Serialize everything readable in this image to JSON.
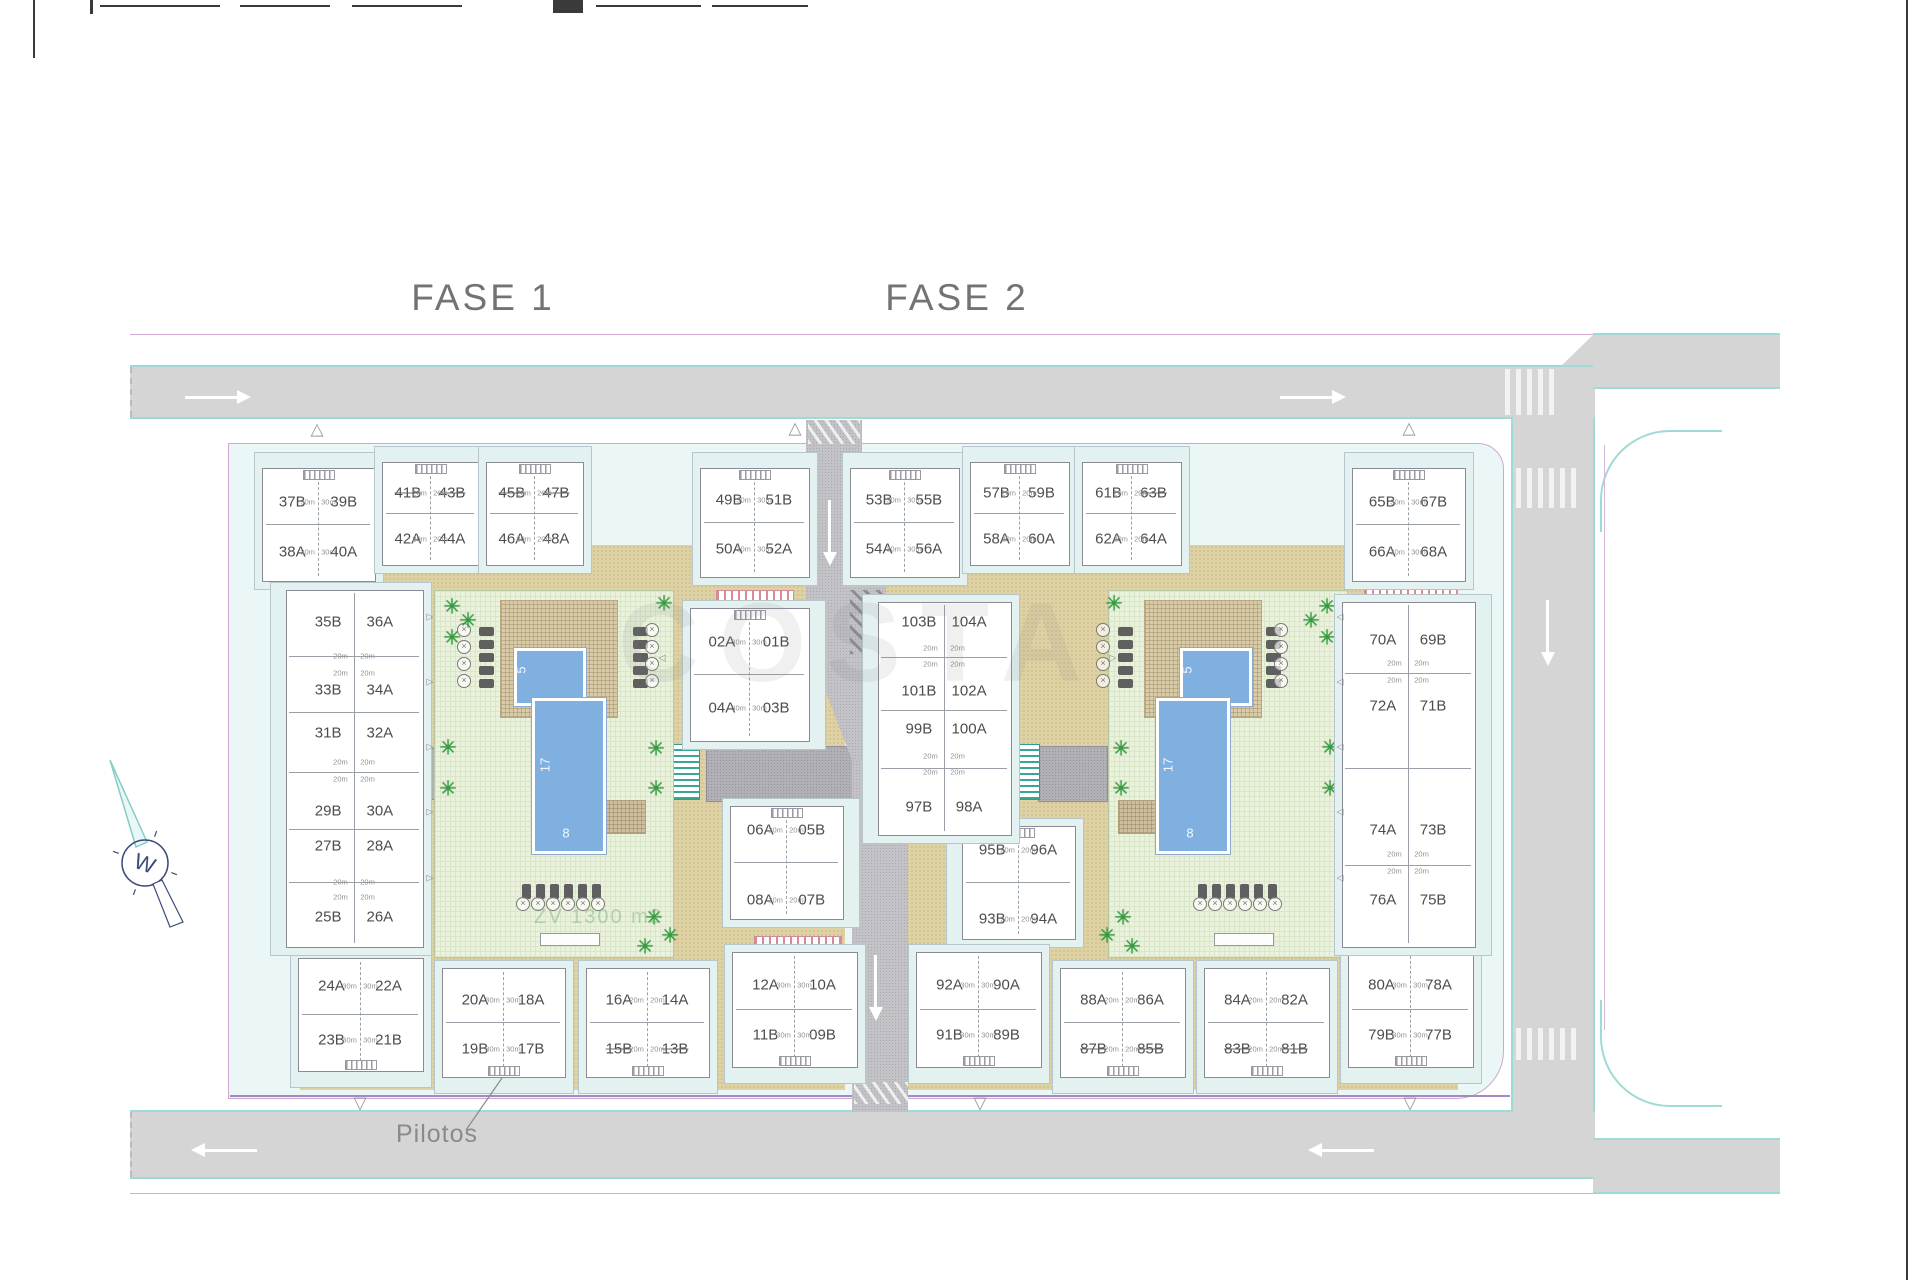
{
  "titles": [
    {
      "text": "FASE 1",
      "x": 483,
      "y": 277
    },
    {
      "text": "FASE 2",
      "x": 957,
      "y": 277
    }
  ],
  "watermark": "COSTA",
  "green_area_label": "ZV 1300 m2",
  "pilotos_label": "Pilotos",
  "compass_letter": "W",
  "pool_dims": {
    "length": "17",
    "width": "8",
    "kids": "5"
  },
  "strikes": [
    "41B",
    "43B",
    "45B",
    "47B",
    "15B",
    "13B",
    "63B",
    "87B",
    "85B",
    "83B",
    "81B"
  ],
  "plan": {
    "quads": [
      {
        "id": "q1",
        "x": 262,
        "y": 468,
        "w": 112,
        "h": 112,
        "tl": "37B",
        "tr": "39B",
        "bl": "38A",
        "br": "40A",
        "area": "30m",
        "pad": "top"
      },
      {
        "id": "q2",
        "x": 382,
        "y": 462,
        "w": 96,
        "h": 102,
        "tl": "41B",
        "tr": "43B",
        "bl": "42A",
        "br": "44A",
        "area": "20m",
        "pad": "top"
      },
      {
        "id": "q3",
        "x": 486,
        "y": 462,
        "w": 96,
        "h": 102,
        "tl": "45B",
        "tr": "47B",
        "bl": "46A",
        "br": "48A",
        "area": "20m",
        "pad": "top"
      },
      {
        "id": "q4",
        "x": 700,
        "y": 468,
        "w": 108,
        "h": 108,
        "tl": "49B",
        "tr": "51B",
        "bl": "50A",
        "br": "52A",
        "area": "30m",
        "pad": "top"
      },
      {
        "id": "q5",
        "x": 850,
        "y": 468,
        "w": 108,
        "h": 108,
        "tl": "53B",
        "tr": "55B",
        "bl": "54A",
        "br": "56A",
        "area": "30m",
        "pad": "top"
      },
      {
        "id": "q6",
        "x": 970,
        "y": 462,
        "w": 98,
        "h": 102,
        "tl": "57B",
        "tr": "59B",
        "bl": "58A",
        "br": "60A",
        "area": "20m",
        "pad": "top"
      },
      {
        "id": "q7",
        "x": 1082,
        "y": 462,
        "w": 98,
        "h": 102,
        "tl": "61B",
        "tr": "63B",
        "bl": "62A",
        "br": "64A",
        "area": "20m",
        "pad": "top"
      },
      {
        "id": "q8",
        "x": 1352,
        "y": 468,
        "w": 112,
        "h": 112,
        "tl": "65B",
        "tr": "67B",
        "bl": "66A",
        "br": "68A",
        "area": "30m",
        "pad": "top"
      },
      {
        "id": "q9",
        "x": 690,
        "y": 608,
        "w": 118,
        "h": 132,
        "tl": "02A",
        "tr": "01B",
        "bl": "04A",
        "br": "03B",
        "area": "30m",
        "pad": "right",
        "r1": 0.26,
        "r2": 0.76
      },
      {
        "id": "q10",
        "x": 730,
        "y": 806,
        "w": 112,
        "h": 112,
        "tl": "06A",
        "tr": "05B",
        "bl": "08A",
        "br": "07B",
        "area": "20m",
        "pad": "right",
        "r1": 0.21,
        "r2": 0.84
      },
      {
        "id": "q11",
        "x": 962,
        "y": 826,
        "w": 112,
        "h": 112,
        "tl": "95B",
        "tr": "96A",
        "bl": "93B",
        "br": "94A",
        "area": "20m",
        "pad": "left",
        "r1": 0.21,
        "r2": 0.83
      },
      {
        "id": "q12",
        "x": 298,
        "y": 958,
        "w": 124,
        "h": 112,
        "tl": "24A",
        "tr": "22A",
        "bl": "23B",
        "br": "21B",
        "area": "30m",
        "pad": "bottom",
        "r1": 0.25,
        "r2": 0.73
      },
      {
        "id": "q13",
        "x": 442,
        "y": 968,
        "w": 122,
        "h": 108,
        "tl": "20A",
        "tr": "18A",
        "bl": "19B",
        "br": "17B",
        "area": "30m",
        "pad": "bottom"
      },
      {
        "id": "q14",
        "x": 586,
        "y": 968,
        "w": 122,
        "h": 108,
        "tl": "16A",
        "tr": "14A",
        "bl": "15B",
        "br": "13B",
        "area": "20m",
        "pad": "bottom"
      },
      {
        "id": "q15",
        "x": 732,
        "y": 952,
        "w": 124,
        "h": 114,
        "tl": "12A",
        "tr": "10A",
        "bl": "11B",
        "br": "09B",
        "area": "30m",
        "pad": "bottom",
        "r1": 0.29,
        "r2": 0.73
      },
      {
        "id": "q16",
        "x": 916,
        "y": 952,
        "w": 124,
        "h": 114,
        "tl": "92A",
        "tr": "90A",
        "bl": "91B",
        "br": "89B",
        "area": "30m",
        "pad": "bottom",
        "r1": 0.29,
        "r2": 0.73
      },
      {
        "id": "q17",
        "x": 1060,
        "y": 968,
        "w": 124,
        "h": 108,
        "tl": "88A",
        "tr": "86A",
        "bl": "87B",
        "br": "85B",
        "area": "20m",
        "pad": "bottom"
      },
      {
        "id": "q18",
        "x": 1204,
        "y": 968,
        "w": 124,
        "h": 108,
        "tl": "84A",
        "tr": "82A",
        "bl": "83B",
        "br": "81B",
        "area": "20m",
        "pad": "bottom"
      },
      {
        "id": "q19",
        "x": 1348,
        "y": 952,
        "w": 124,
        "h": 114,
        "tl": "80A",
        "tr": "78A",
        "bl": "79B",
        "br": "77B",
        "area": "30m",
        "pad": "bottom",
        "r1": 0.29,
        "r2": 0.73
      }
    ],
    "strips": [
      {
        "id": "s1",
        "x": 286,
        "y": 590,
        "w": 136,
        "h": 356,
        "pad": "left",
        "area": "20m",
        "pairs": [
          {
            "l": "35B",
            "r": "36A",
            "y": 622
          },
          {
            "l": "33B",
            "r": "34A",
            "y": 690
          },
          {
            "l": "31B",
            "r": "32A",
            "y": 733
          },
          {
            "l": "29B",
            "r": "30A",
            "y": 811
          },
          {
            "l": "27B",
            "r": "28A",
            "y": 846
          },
          {
            "l": "25B",
            "r": "26A",
            "y": 917
          }
        ],
        "area_rows": [
          656,
          673,
          762,
          779,
          882,
          897
        ]
      },
      {
        "id": "s2",
        "x": 878,
        "y": 602,
        "w": 132,
        "h": 232,
        "pad": "left",
        "area": "20m",
        "pairs": [
          {
            "l": "103B",
            "r": "104A",
            "y": 622
          },
          {
            "l": "101B",
            "r": "102A",
            "y": 691
          },
          {
            "l": "99B",
            "r": "100A",
            "y": 729
          },
          {
            "l": "97B",
            "r": "98A",
            "y": 807
          }
        ],
        "area_rows": [
          648,
          664,
          756,
          772
        ]
      },
      {
        "id": "s3",
        "x": 1342,
        "y": 602,
        "w": 132,
        "h": 344,
        "pad": "right",
        "area": "20m",
        "pairs": [
          {
            "l": "70A",
            "r": "69B",
            "y": 640
          },
          {
            "l": "72A",
            "r": "71B",
            "y": 706
          },
          {
            "l": "74A",
            "r": "73B",
            "y": 830
          },
          {
            "l": "76A",
            "r": "75B",
            "y": 900
          }
        ],
        "area_rows": [
          663,
          680,
          854,
          871
        ]
      }
    ],
    "courtyards": [
      {
        "id": "c1",
        "green": [
          434,
          590,
          238,
          366
        ],
        "deck": [
          500,
          600,
          116,
          116
        ],
        "kids": [
          514,
          648,
          66,
          52
        ],
        "main": [
          532,
          698,
          68,
          150
        ],
        "bench": [
          540,
          933,
          58,
          11
        ],
        "patch": [
          604,
          800,
          40,
          32
        ],
        "dim_len": [
          545,
          765
        ],
        "dim_wid": [
          566,
          833
        ],
        "dim_kid": [
          521,
          670
        ],
        "loungersV": [
          {
            "x": 479,
            "ys": [
              627,
              640,
              653,
              666,
              679
            ]
          },
          {
            "x": 633,
            "ys": [
              627,
              640,
              653,
              666,
              679
            ]
          }
        ],
        "parasolsV": [
          {
            "x": 464,
            "ys": [
              630,
              647,
              664,
              681
            ]
          },
          {
            "x": 652,
            "ys": [
              630,
              647,
              664,
              681
            ]
          }
        ],
        "loungersH": {
          "y": 884,
          "xs": [
            522,
            536,
            550,
            564,
            578,
            592
          ]
        },
        "parasolsH": {
          "y": 904,
          "xs": [
            523,
            538,
            553,
            568,
            583,
            598
          ]
        },
        "palms": [
          [
            452,
            607
          ],
          [
            468,
            621
          ],
          [
            452,
            638
          ],
          [
            448,
            748
          ],
          [
            448,
            789
          ],
          [
            664,
            604
          ],
          [
            656,
            749
          ],
          [
            656,
            789
          ],
          [
            654,
            918
          ],
          [
            670,
            936
          ],
          [
            645,
            947
          ]
        ],
        "zv": true
      },
      {
        "id": "c2",
        "green": [
          1108,
          590,
          238,
          366
        ],
        "deck": [
          1144,
          600,
          116,
          116
        ],
        "kids": [
          1180,
          648,
          66,
          52
        ],
        "main": [
          1156,
          698,
          68,
          150
        ],
        "bench": [
          1214,
          933,
          58,
          11
        ],
        "patch": [
          1118,
          800,
          40,
          32
        ],
        "dim_len": [
          1168,
          765
        ],
        "dim_wid": [
          1190,
          833
        ],
        "dim_kid": [
          1187,
          670
        ],
        "loungersV": [
          {
            "x": 1118,
            "ys": [
              627,
              640,
              653,
              666,
              679
            ]
          },
          {
            "x": 1266,
            "ys": [
              627,
              640,
              653,
              666,
              679
            ]
          }
        ],
        "parasolsV": [
          {
            "x": 1103,
            "ys": [
              630,
              647,
              664,
              681
            ]
          },
          {
            "x": 1281,
            "ys": [
              630,
              647,
              664,
              681
            ]
          }
        ],
        "loungersH": {
          "y": 884,
          "xs": [
            1198,
            1212,
            1226,
            1240,
            1254,
            1268
          ]
        },
        "parasolsH": {
          "y": 904,
          "xs": [
            1200,
            1215,
            1230,
            1245,
            1260,
            1275
          ]
        },
        "palms": [
          [
            1327,
            607
          ],
          [
            1311,
            621
          ],
          [
            1327,
            638
          ],
          [
            1330,
            748
          ],
          [
            1330,
            789
          ],
          [
            1114,
            604
          ],
          [
            1121,
            749
          ],
          [
            1121,
            789
          ],
          [
            1123,
            918
          ],
          [
            1107,
            936
          ],
          [
            1132,
            947
          ]
        ],
        "zv": false
      }
    ],
    "sand_zones": [
      [
        300,
        545,
        545,
        545
      ],
      [
        858,
        545,
        600,
        545
      ]
    ],
    "pink_bands": [
      [
        716,
        590,
        76,
        13
      ],
      [
        754,
        936,
        86,
        12
      ],
      [
        1364,
        588,
        92,
        12
      ],
      [
        1368,
        934,
        88,
        12
      ]
    ],
    "teal_benches": [
      [
        670,
        744,
        28,
        54
      ],
      [
        1010,
        744,
        28,
        54
      ],
      [
        1316,
        744,
        28,
        54
      ]
    ],
    "dark_paths": [
      [
        706,
        746,
        150,
        54
      ],
      [
        1038,
        746,
        68,
        54
      ],
      [
        1346,
        748,
        56,
        50
      ],
      [
        408,
        748,
        26,
        50
      ]
    ],
    "arrows": [
      {
        "d": "r",
        "x": 185,
        "y": 390
      },
      {
        "d": "r",
        "x": 1280,
        "y": 390
      },
      {
        "d": "l",
        "x": 205,
        "y": 1143
      },
      {
        "d": "l",
        "x": 1322,
        "y": 1143
      },
      {
        "d": "d",
        "x": 1546,
        "y": 600
      },
      {
        "d": "d",
        "x": 828,
        "y": 500
      },
      {
        "d": "d",
        "x": 874,
        "y": 955
      }
    ],
    "entry_triangles": [
      {
        "s": "△",
        "x": 317,
        "y": 429
      },
      {
        "s": "△",
        "x": 795,
        "y": 428
      },
      {
        "s": "△",
        "x": 1409,
        "y": 428
      },
      {
        "s": "▽",
        "x": 360,
        "y": 1103
      },
      {
        "s": "▽",
        "x": 980,
        "y": 1103
      },
      {
        "s": "▽",
        "x": 1410,
        "y": 1103
      }
    ],
    "mini_triangles": [
      {
        "s": "▷",
        "x": 430,
        "y": 617
      },
      {
        "s": "▷",
        "x": 430,
        "y": 682
      },
      {
        "s": "▷",
        "x": 430,
        "y": 747
      },
      {
        "s": "▷",
        "x": 430,
        "y": 812
      },
      {
        "s": "▷",
        "x": 430,
        "y": 878
      },
      {
        "s": "◁",
        "x": 662,
        "y": 658
      },
      {
        "s": "◁",
        "x": 1340,
        "y": 617
      },
      {
        "s": "◁",
        "x": 1340,
        "y": 682
      },
      {
        "s": "◁",
        "x": 1340,
        "y": 747
      },
      {
        "s": "◁",
        "x": 1340,
        "y": 812
      },
      {
        "s": "◁",
        "x": 1340,
        "y": 878
      },
      {
        "s": "▷",
        "x": 1113,
        "y": 658
      }
    ],
    "crosswalks": [
      [
        1505,
        369,
        54,
        46
      ],
      [
        1516,
        468,
        62,
        40
      ],
      [
        1516,
        1028,
        62,
        32
      ]
    ],
    "chevrons": [
      [
        808,
        420,
        52,
        24
      ],
      [
        854,
        1082,
        54,
        22
      ]
    ],
    "hatches": [
      [
        850,
        590,
        36,
        64
      ]
    ],
    "frame_marks": [
      [
        33,
        0,
        2,
        58
      ],
      [
        90,
        0,
        3,
        14
      ],
      [
        100,
        5,
        120,
        2
      ],
      [
        240,
        5,
        90,
        2
      ],
      [
        352,
        5,
        110,
        2
      ],
      [
        553,
        0,
        30,
        13
      ],
      [
        596,
        5,
        105,
        2
      ],
      [
        712,
        5,
        96,
        2
      ],
      [
        1906,
        0,
        2,
        1280
      ]
    ],
    "zv_pos": [
      534,
      906
    ],
    "watermark_pos": [
      618,
      578
    ],
    "pilotos_pos": [
      396,
      1120
    ],
    "leader": [
      466,
      1130,
      502,
      1078
    ]
  }
}
